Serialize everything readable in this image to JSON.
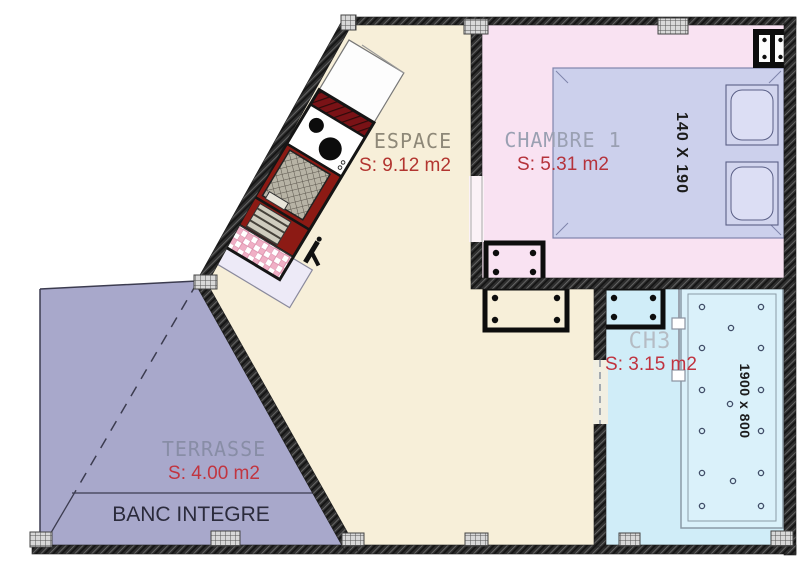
{
  "title": "Floor plan",
  "rooms": {
    "espace": {
      "label": "ESPACE",
      "area": "S: 9.12 m2"
    },
    "chambre1": {
      "label": "CHAMBRE 1",
      "area": "S: 5.31 m2"
    },
    "ch3": {
      "label": "CH3",
      "area": "S: 3.15 m2"
    },
    "terrasse": {
      "label": "TERRASSE",
      "area": "S: 4.00 m2"
    }
  },
  "furniture": {
    "bench_label": "BANC INTEGRE",
    "bed_dimensions": "140 X 190",
    "shower_dimensions": "1900 x 800"
  },
  "colors": {
    "espace_floor": "#f7efd9",
    "chambre_floor": "#f9e2f2",
    "ch3_floor": "#d0edf8",
    "shower_tray": "#daf1fa",
    "terrasse_floor": "#a8a8cb",
    "bed": "#ccd0ec",
    "pillow": "#d2d5ee",
    "kitchen_red": "#8c1a14",
    "wall": "#2e2e2e",
    "area_text": "#b5333c",
    "room_label_text": "#9aa0b2",
    "bench_text": "#2b2b3c"
  }
}
